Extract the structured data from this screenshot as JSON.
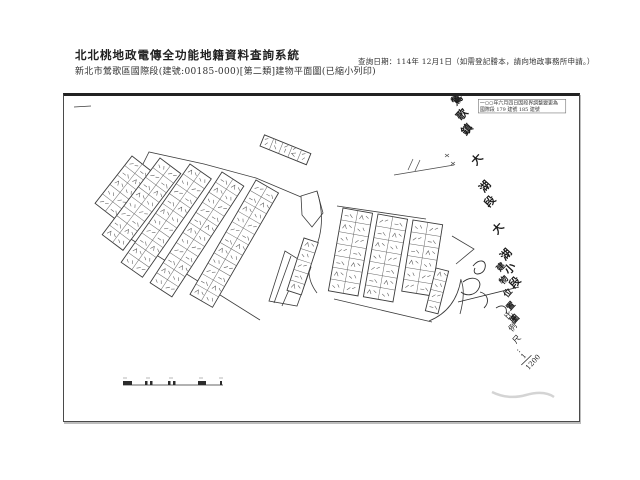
{
  "header": {
    "system_title": "北北桃地政電傳全功能地籍資料查詢系統",
    "subtitle": "新北市鶯歌區國際段(建號:00185-000)[第二類]建物平面圖(已縮小列印)",
    "query_note": "查詢日期：114年 12月1日（如需登記謄本，請向地政事務所申請。）"
  },
  "document": {
    "stamp": {
      "line1": "一○○年六月四日因段界調整變更為",
      "line2": "國際段 179 建號 185 建號"
    },
    "section_label": "鶯歌鎮大湖段大湖小段",
    "map_type_label": "建物位置圖",
    "scale_label": "比例尺:",
    "scale_fraction_numerator": "1",
    "scale_fraction_denominator": "1200"
  }
}
